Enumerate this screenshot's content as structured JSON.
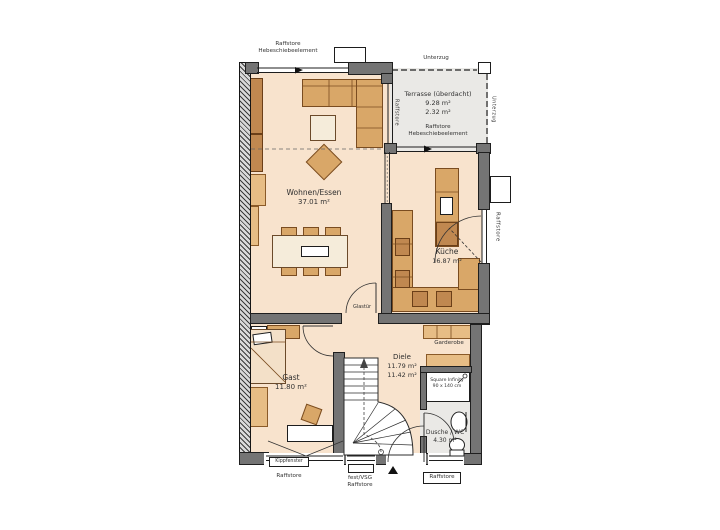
{
  "plan": {
    "rooms": {
      "wohnen_essen": {
        "name": "Wohnen/Essen",
        "area": "37.01 m²"
      },
      "terrasse": {
        "name": "Terrasse (überdacht)",
        "area_1": "9.28 m²",
        "area_2": "2.32 m²"
      },
      "kueche": {
        "name": "Küche",
        "area": "16.87 m²"
      },
      "gast": {
        "name": "Gast",
        "area": "11.80 m²"
      },
      "diele": {
        "name": "Diele",
        "area_1": "11.79 m²",
        "area_2": "11.42 m²"
      },
      "dusche_wc": {
        "name": "Dusche / WC",
        "area": "4.30 m²"
      }
    },
    "annotations": {
      "raffstore_top_l1": "Raffstore",
      "raffstore_top_l2": "Hebeschiebeelement",
      "unterzug_top": "Unterzug",
      "unterzug_right": "Unterzug",
      "raffstore_terrace_window": "Raffstore",
      "raffstore_terrace_l1": "Raffstore",
      "raffstore_terrace_l2": "Hebeschiebeelement",
      "raffstore_kitchen_window": "Raffstore",
      "glastuer": "Glastür",
      "garderobe": "Garderobe",
      "shower_l1": "Square Infinity",
      "shower_l2": "90 x 140 cm",
      "kippfenster": "Kippfenster",
      "raffstore_gast_window": "Raffstore",
      "fest_vsg_l1": "fest/VSG",
      "fest_vsg_l2": "Raffstore",
      "raffstore_wc_window": "Raffstore"
    },
    "palette": {
      "floor": "#f8e3cd",
      "terrace_floor": "#eae9e6",
      "wall": "#747474",
      "furniture": "#d9a768",
      "furniture_dark": "#c08850",
      "outline": "#7a4c20"
    }
  }
}
